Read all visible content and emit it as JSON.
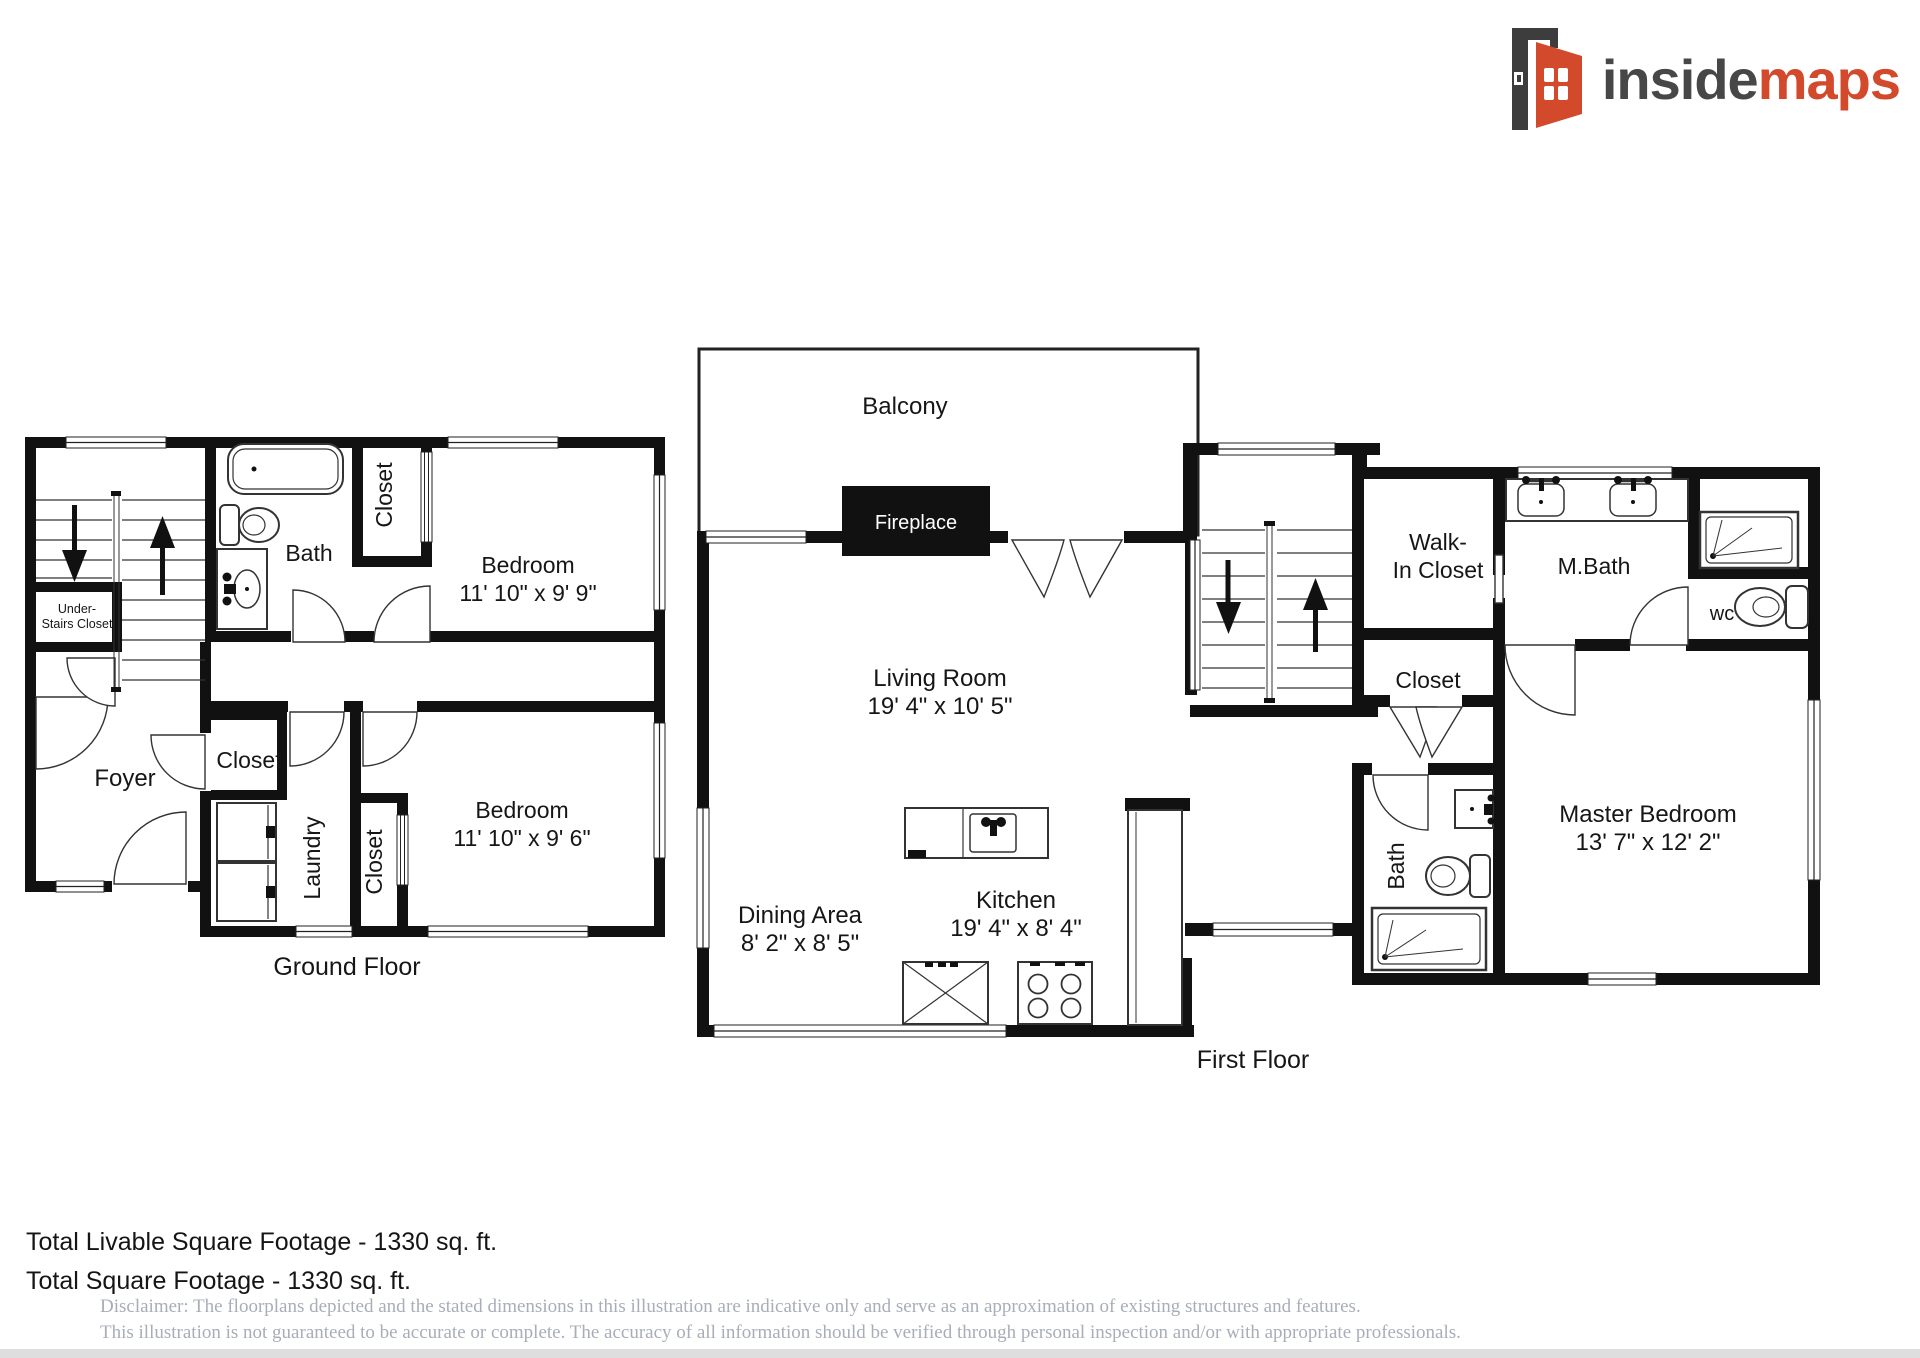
{
  "brand": {
    "name_primary": "inside",
    "name_secondary": "maps",
    "primary_color": "#474747",
    "accent_color": "#d3492c"
  },
  "floors": {
    "ground": {
      "label": "Ground Floor",
      "rooms": {
        "under_stairs": {
          "line1": "Under-",
          "line2": "Stairs Closet"
        },
        "bath": {
          "name": "Bath"
        },
        "closet_top": {
          "name": "Closet"
        },
        "bedroom1": {
          "name": "Bedroom",
          "dims": "11' 10\" x 9' 9\""
        },
        "foyer": {
          "name": "Foyer"
        },
        "closet_hall": {
          "name": "Closet"
        },
        "laundry": {
          "name": "Laundry"
        },
        "closet_lower": {
          "name": "Closet"
        },
        "bedroom2": {
          "name": "Bedroom",
          "dims": "11' 10\" x 9' 6\""
        }
      }
    },
    "first": {
      "label": "First Floor",
      "rooms": {
        "balcony": {
          "name": "Balcony"
        },
        "fireplace": {
          "name": "Fireplace"
        },
        "living": {
          "name": "Living Room",
          "dims": "19' 4\" x 10' 5\""
        },
        "dining": {
          "name": "Dining Area",
          "dims": "8' 2\" x 8' 5\""
        },
        "kitchen": {
          "name": "Kitchen",
          "dims": "19' 4\" x 8' 4\""
        },
        "walk_in": {
          "line1": "Walk-",
          "line2": "In Closet"
        },
        "mbath": {
          "name": "M.Bath"
        },
        "wc": {
          "name": "wc"
        },
        "closet": {
          "name": "Closet"
        },
        "bath": {
          "name": "Bath"
        },
        "master": {
          "name": "Master Bedroom",
          "dims": "13' 7\" x 12' 2\""
        }
      }
    }
  },
  "footer": {
    "total_livable": "Total Livable Square Footage - 1330 sq. ft.",
    "total": "Total Square Footage - 1330 sq. ft.",
    "disclaimer_line1": "Disclaimer: The floorplans depicted and the stated dimensions in this illustration are indicative only and serve as an approximation of existing structures and features.",
    "disclaimer_line2": "This illustration is not guaranteed to be accurate or complete. The accuracy of all information should be verified through personal inspection and/or with appropriate professionals."
  }
}
